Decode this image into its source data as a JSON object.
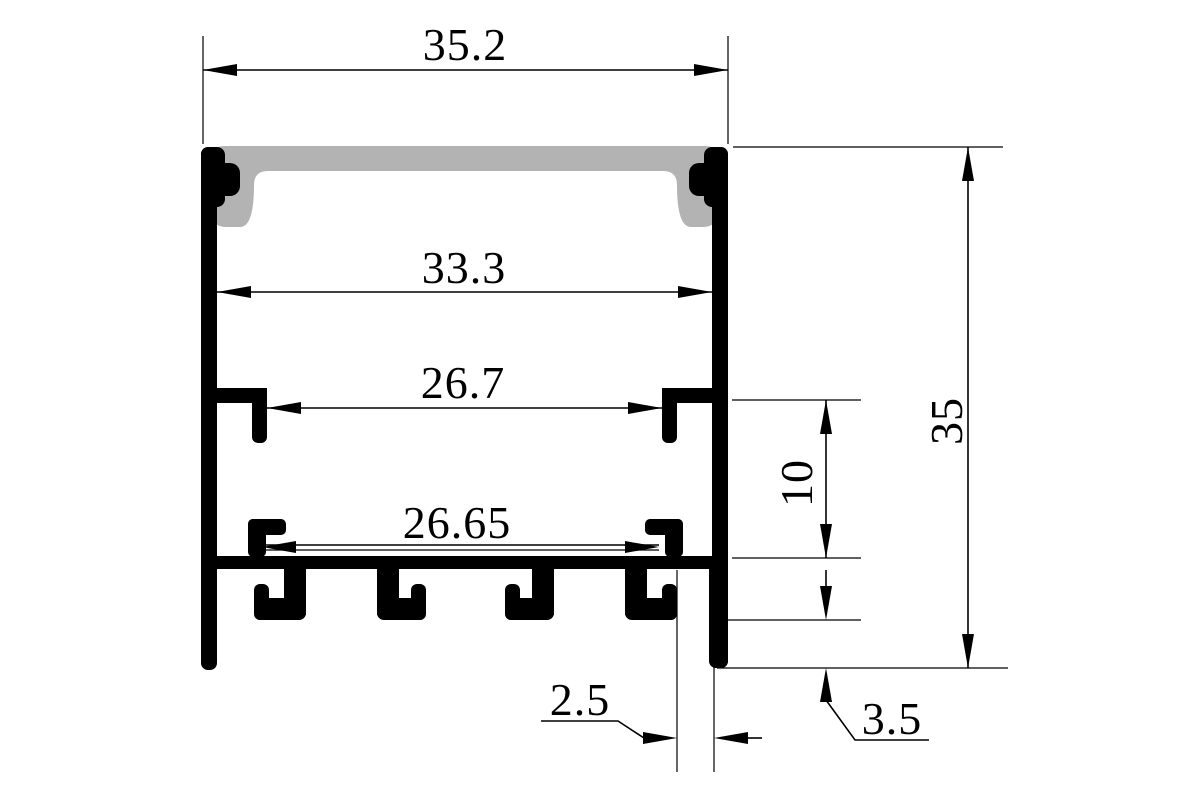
{
  "colors": {
    "background": "#ffffff",
    "profile": "#000000",
    "diffuser": "#b3b3b3",
    "dimension": "#000000"
  },
  "dimensions": {
    "overall_width": "35.2",
    "inner_width": "33.3",
    "clip_opening_width": "26.7",
    "base_inner_width": "26.65",
    "overall_height": "35",
    "lower_wall_height": "10",
    "edge_slot_width": "2.5",
    "bottom_flange_height": "3.5"
  }
}
